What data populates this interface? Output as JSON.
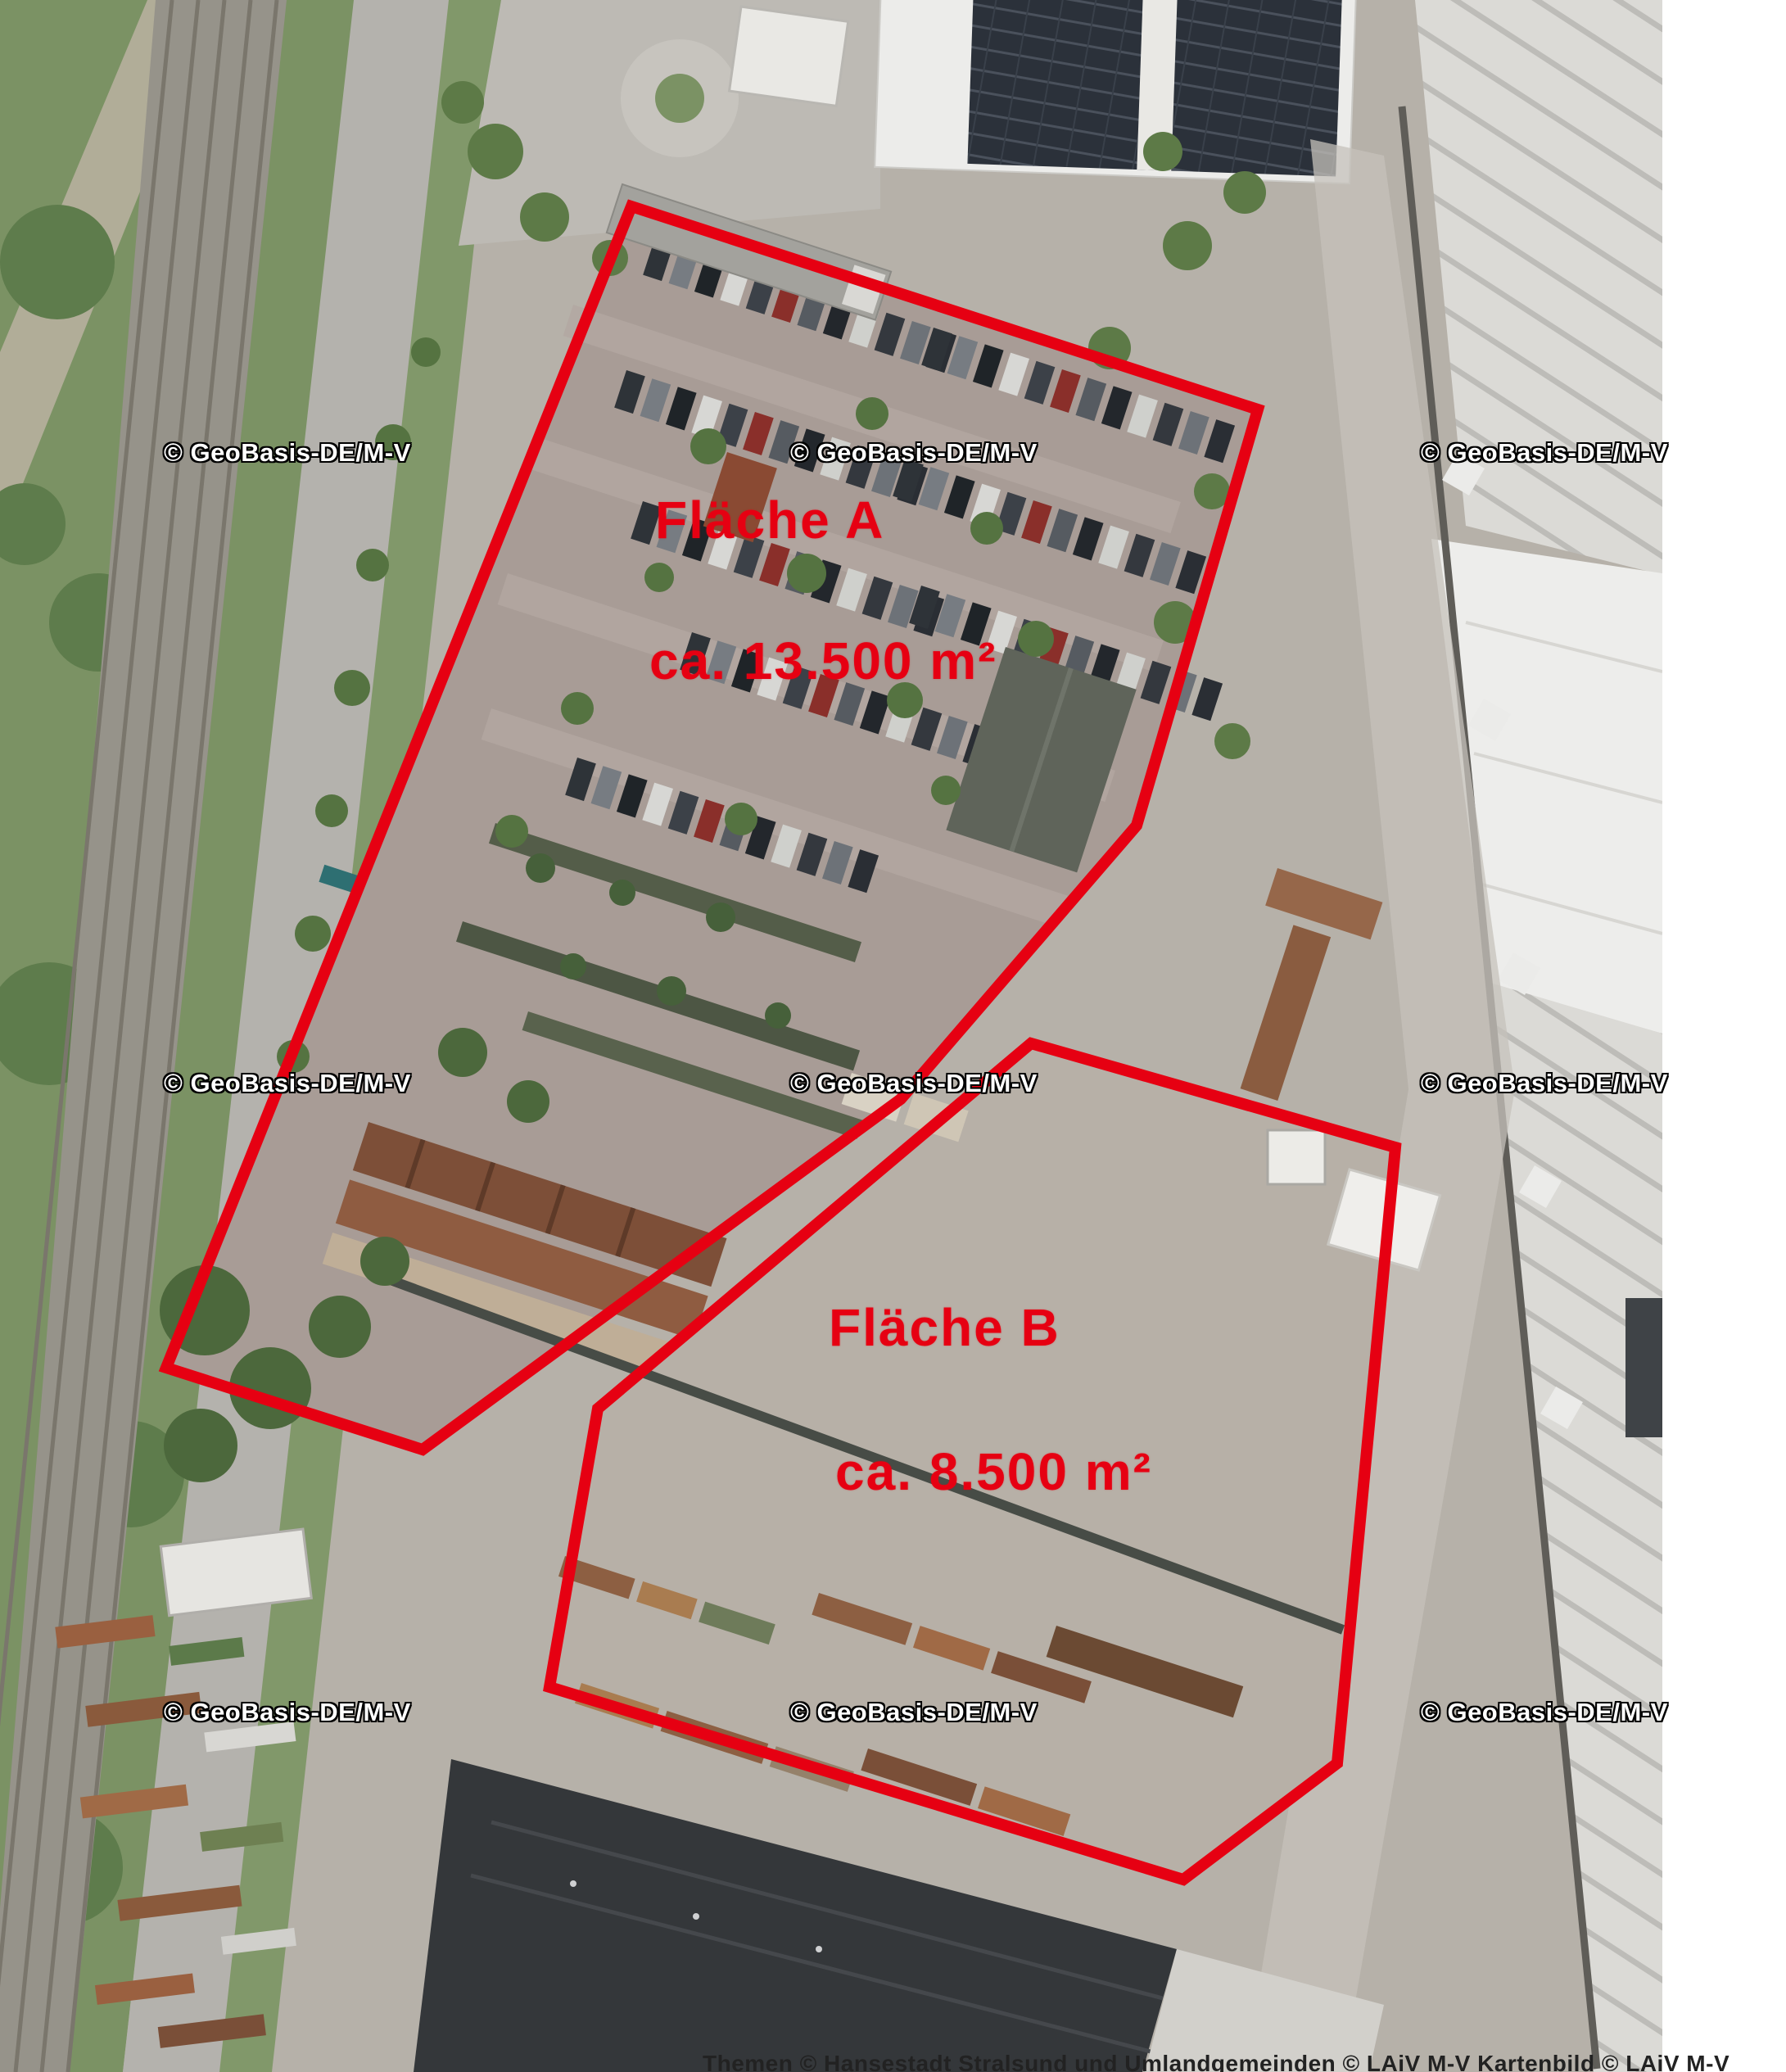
{
  "map": {
    "type": "aerial-photo",
    "description": "Orthophoto of an industrial / railway area with two marked plots"
  },
  "annotations": {
    "outline_color": "#e60012",
    "label_color": "#e60012",
    "area_a": {
      "name": "Fläche A",
      "size": "ca. 13.500 m²"
    },
    "area_b": {
      "name": "Fläche B",
      "size": "ca. 8.500 m²"
    },
    "area_a_polygon": "771,252 1536,500 1388,1008 1100,1342 516,1770 203,1670",
    "area_b_polygon": "1259,1274 1704,1401 1633,2153 1445,2295 671,2060 730,1720"
  },
  "watermark": {
    "text": "© GeoBasis-DE/M-V",
    "color": "#ffffff",
    "outline": "#000000"
  },
  "attribution": {
    "text": "Themen © Hansestadt Stralsund und Umlandgemeinden © LAiV M-V Kartenbild © LAiV M-V"
  }
}
